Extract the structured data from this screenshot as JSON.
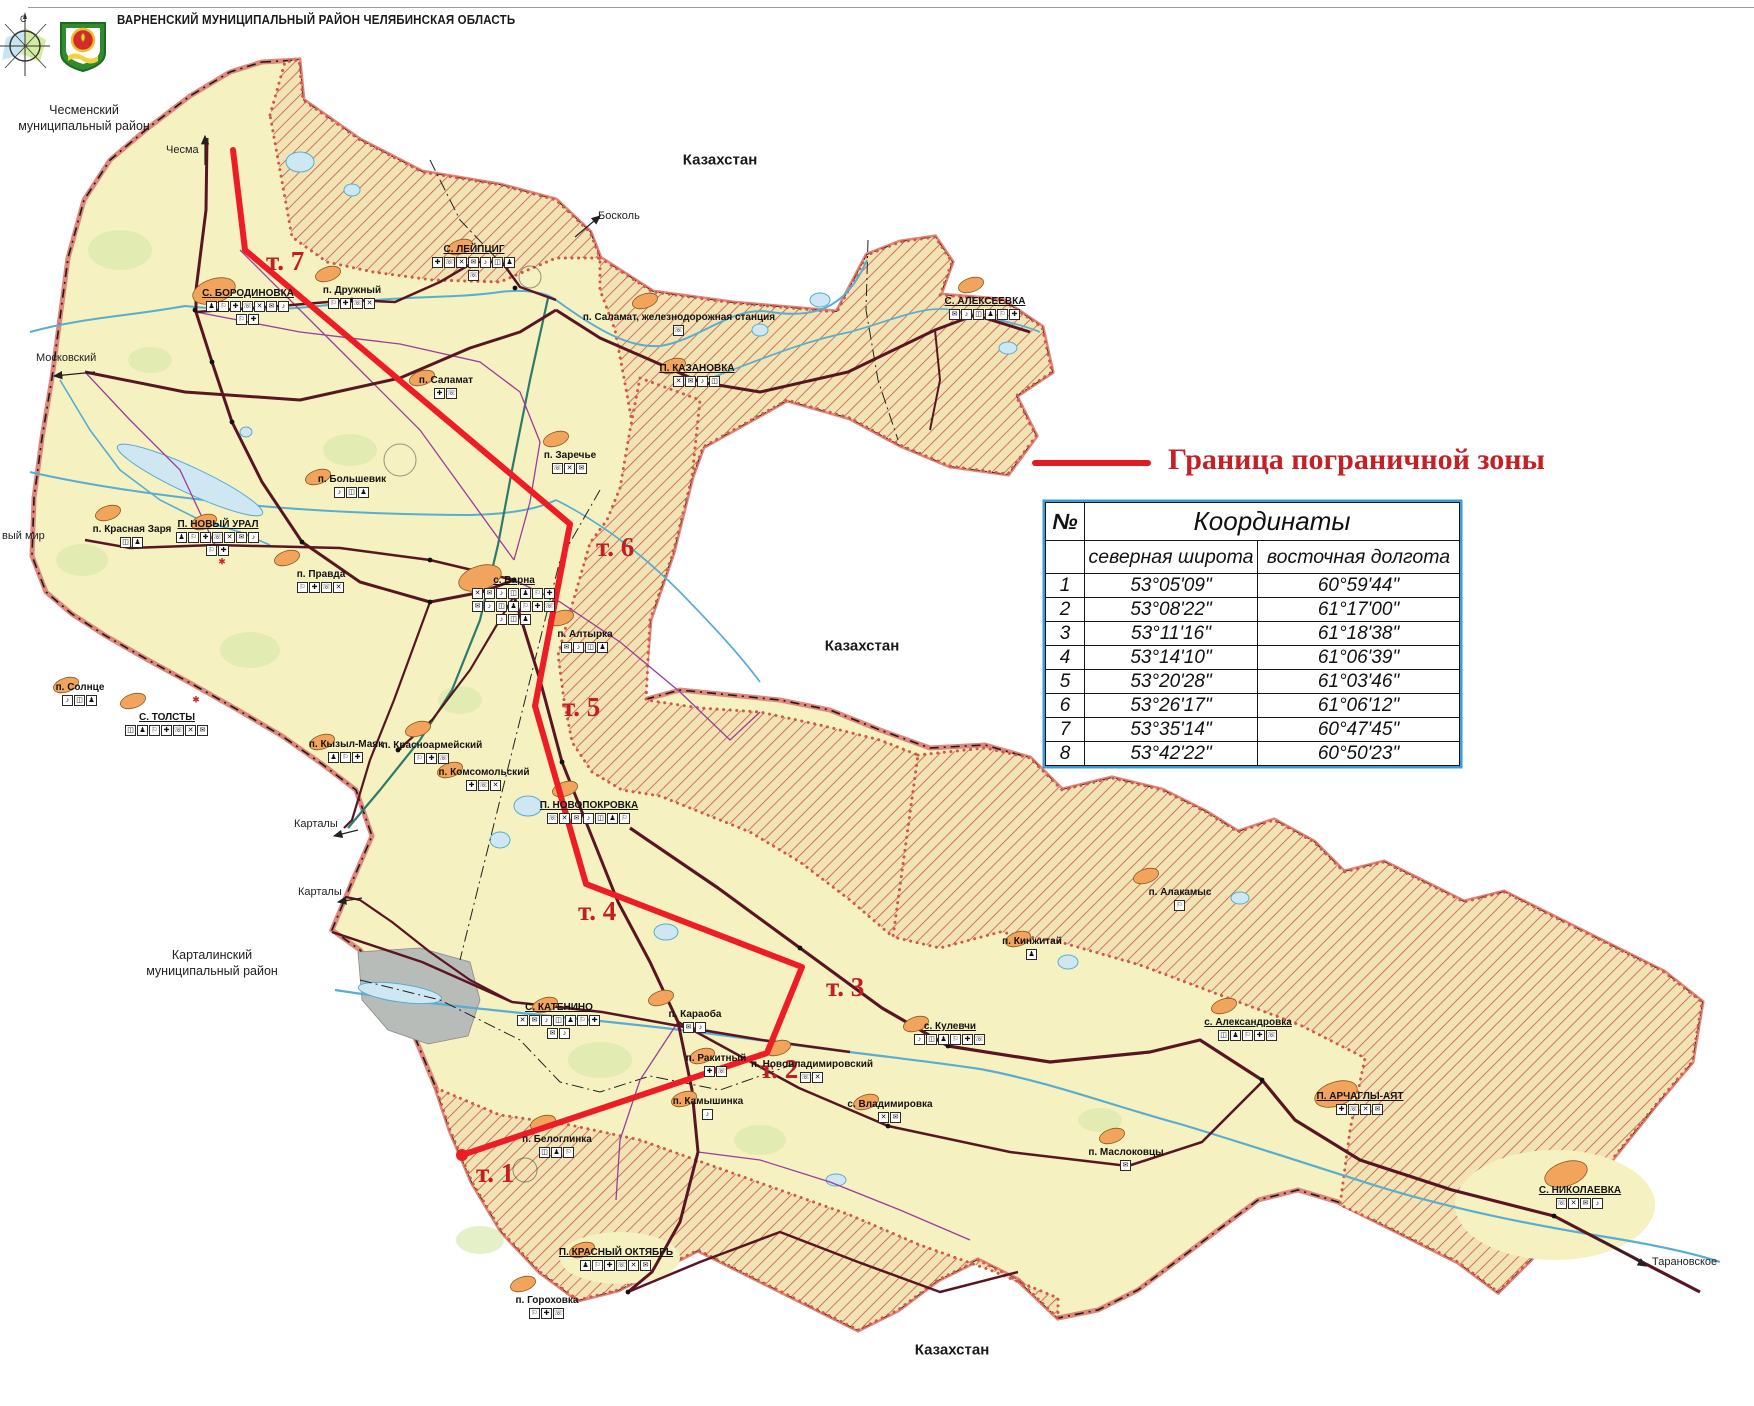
{
  "header": {
    "title": "ВАРНЕНСКИЙ МУНИЦИПАЛЬНЫЙ РАЙОН ЧЕЛЯБИНСКАЯ ОБЛАСТЬ"
  },
  "legend": {
    "label": "Граница пограничной зоны",
    "line_color": "#e01b22"
  },
  "table": {
    "col_no": "№",
    "title": "Координаты",
    "col_lat": "северная широта",
    "col_lon": "восточная долгота",
    "rows": [
      {
        "n": "1",
        "lat": "53°05'09\"",
        "lon": "60°59'44\""
      },
      {
        "n": "2",
        "lat": "53°08'22\"",
        "lon": "61°17'00\""
      },
      {
        "n": "3",
        "lat": "53°11'16\"",
        "lon": "61°18'38\""
      },
      {
        "n": "4",
        "lat": "53°14'10\"",
        "lon": "61°06'39\""
      },
      {
        "n": "5",
        "lat": "53°20'28\"",
        "lon": "61°03'46\""
      },
      {
        "n": "6",
        "lat": "53°26'17\"",
        "lon": "61°06'12\""
      },
      {
        "n": "7",
        "lat": "53°35'14\"",
        "lon": "60°47'45\""
      },
      {
        "n": "8",
        "lat": "53°42'22\"",
        "lon": "60°50'23\""
      }
    ]
  },
  "map": {
    "border_zone": {
      "color": "#ee1c25",
      "points": [
        [
          233,
          150
        ],
        [
          245,
          250
        ],
        [
          570,
          524
        ],
        [
          535,
          706
        ],
        [
          586,
          884
        ],
        [
          802,
          967
        ],
        [
          767,
          1053
        ],
        [
          462,
          1155
        ]
      ],
      "point_labels": [
        {
          "label": "т. 7",
          "x": 266,
          "y": 248
        },
        {
          "label": "т. 6",
          "x": 596,
          "y": 534
        },
        {
          "label": "т. 5",
          "x": 562,
          "y": 694
        },
        {
          "label": "т. 4",
          "x": 578,
          "y": 898
        },
        {
          "label": "т. 3",
          "x": 826,
          "y": 974
        },
        {
          "label": "т. 2",
          "x": 760,
          "y": 1056
        },
        {
          "label": "т. 1",
          "x": 476,
          "y": 1160
        }
      ]
    },
    "regions": [
      {
        "text": "Чесменский\nмуниципальный район",
        "x": 84,
        "y": 103
      },
      {
        "text": "Карталинский\nмуниципальный район",
        "x": 212,
        "y": 948
      }
    ],
    "countries": [
      {
        "text": "Казахстан",
        "x": 720,
        "y": 160
      },
      {
        "text": "Казахстан",
        "x": 862,
        "y": 646
      },
      {
        "text": "Казахстан",
        "x": 952,
        "y": 1350
      }
    ],
    "exits": [
      {
        "text": "Чесма",
        "x": 166,
        "y": 144
      },
      {
        "text": "Московский",
        "x": 36,
        "y": 352
      },
      {
        "text": "вый мир",
        "x": 2,
        "y": 530
      },
      {
        "text": "Босколь",
        "x": 598,
        "y": 210
      },
      {
        "text": "Карталы",
        "x": 294,
        "y": 818
      },
      {
        "text": "Карталы",
        "x": 298,
        "y": 886
      },
      {
        "text": "Тарановское",
        "x": 1652,
        "y": 1256
      }
    ],
    "stars": [
      {
        "x": 222,
        "y": 562
      },
      {
        "x": 196,
        "y": 700
      }
    ],
    "settlements": [
      {
        "name": "С. БОРОДИНОВКА",
        "x": 248,
        "y": 289,
        "u": true,
        "big": true,
        "rows": [
          7,
          2
        ]
      },
      {
        "name": "п. Дружный",
        "x": 352,
        "y": 286,
        "rows": [
          4
        ]
      },
      {
        "name": "С. ЛЕЙПЦИГ",
        "x": 474,
        "y": 245,
        "u": true,
        "rows": [
          7,
          1
        ]
      },
      {
        "name": "п. Саламат, железнодорожная станция",
        "x": 679,
        "y": 313,
        "rows": [
          1
        ]
      },
      {
        "name": "П. КАЗАНОВКА",
        "x": 697,
        "y": 364,
        "u": true,
        "rows": [
          4
        ]
      },
      {
        "name": "С. АЛЕКСЕЕВКА",
        "x": 985,
        "y": 297,
        "u": true,
        "rows": [
          6
        ]
      },
      {
        "name": "п. Большевик",
        "x": 352,
        "y": 475,
        "rows": [
          3
        ]
      },
      {
        "name": "п. Красная Заря",
        "x": 132,
        "y": 525,
        "rows": [
          2
        ]
      },
      {
        "name": "П. НОВЫЙ УРАЛ",
        "x": 218,
        "y": 520,
        "u": true,
        "rows": [
          7,
          2
        ]
      },
      {
        "name": "п. Правда",
        "x": 321,
        "y": 570,
        "rows": [
          4
        ]
      },
      {
        "name": "п. Саламат",
        "x": 446,
        "y": 376,
        "rows": [
          2
        ]
      },
      {
        "name": "п. Заречье",
        "x": 570,
        "y": 451,
        "rows": [
          3
        ]
      },
      {
        "name": "с. Варна",
        "x": 514,
        "y": 576,
        "u": true,
        "big": true,
        "rows": [
          7,
          7,
          3
        ]
      },
      {
        "name": "п. Алтырка",
        "x": 585,
        "y": 630,
        "rows": [
          4
        ]
      },
      {
        "name": "п. Солнце",
        "x": 80,
        "y": 683,
        "rows": [
          3
        ]
      },
      {
        "name": "С. ТОЛСТЫ",
        "x": 167,
        "y": 713,
        "u": true,
        "rows": [
          7
        ]
      },
      {
        "name": "п. Кызыл-Маяк",
        "x": 346,
        "y": 740,
        "rows": [
          3
        ]
      },
      {
        "name": "п. Красноармейский",
        "x": 432,
        "y": 741,
        "rows": [
          3
        ]
      },
      {
        "name": "п. Комсомольский",
        "x": 484,
        "y": 768,
        "rows": [
          3
        ]
      },
      {
        "name": "П. НОВОПОКРОВКА",
        "x": 589,
        "y": 801,
        "u": true,
        "rows": [
          7
        ]
      },
      {
        "name": "С. КАТЕНИНО",
        "x": 559,
        "y": 1003,
        "u": true,
        "rows": [
          7,
          2
        ]
      },
      {
        "name": "п. Караоба",
        "x": 695,
        "y": 1010,
        "rows": [
          2
        ]
      },
      {
        "name": "п. Камышинка",
        "x": 708,
        "y": 1097,
        "rows": [
          1
        ]
      },
      {
        "name": "п. Белоглинка",
        "x": 557,
        "y": 1135,
        "rows": [
          3
        ]
      },
      {
        "name": "П. КРАСНЫЙ ОКТЯБРЬ",
        "x": 616,
        "y": 1248,
        "u": true,
        "rows": [
          6
        ]
      },
      {
        "name": "п. Гороховка",
        "x": 547,
        "y": 1296,
        "rows": [
          3
        ]
      },
      {
        "name": "п. Ракитный",
        "x": 716,
        "y": 1054,
        "rows": [
          2
        ]
      },
      {
        "name": "п. Нововладимировский",
        "x": 812,
        "y": 1060,
        "rows": [
          2
        ]
      },
      {
        "name": "с. Владимировка",
        "x": 890,
        "y": 1100,
        "rows": [
          2
        ]
      },
      {
        "name": "п. Маслоковцы",
        "x": 1126,
        "y": 1148,
        "rows": [
          1
        ]
      },
      {
        "name": "с. Кулевчи",
        "x": 950,
        "y": 1022,
        "u": true,
        "rows": [
          6
        ]
      },
      {
        "name": "с. Александровка",
        "x": 1248,
        "y": 1018,
        "u": true,
        "rows": [
          5
        ]
      },
      {
        "name": "п. Кинжитай",
        "x": 1032,
        "y": 937,
        "rows": [
          1
        ]
      },
      {
        "name": "п. Алакамыс",
        "x": 1180,
        "y": 888,
        "rows": [
          1
        ]
      },
      {
        "name": "П. АРЧАГЛЫ-АЯТ",
        "x": 1360,
        "y": 1092,
        "u": true,
        "big": true,
        "rows": [
          4
        ]
      },
      {
        "name": "С. НИКОЛАЕВКА",
        "x": 1580,
        "y": 1186,
        "u": true,
        "big": true,
        "rows": [
          4
        ]
      }
    ]
  }
}
